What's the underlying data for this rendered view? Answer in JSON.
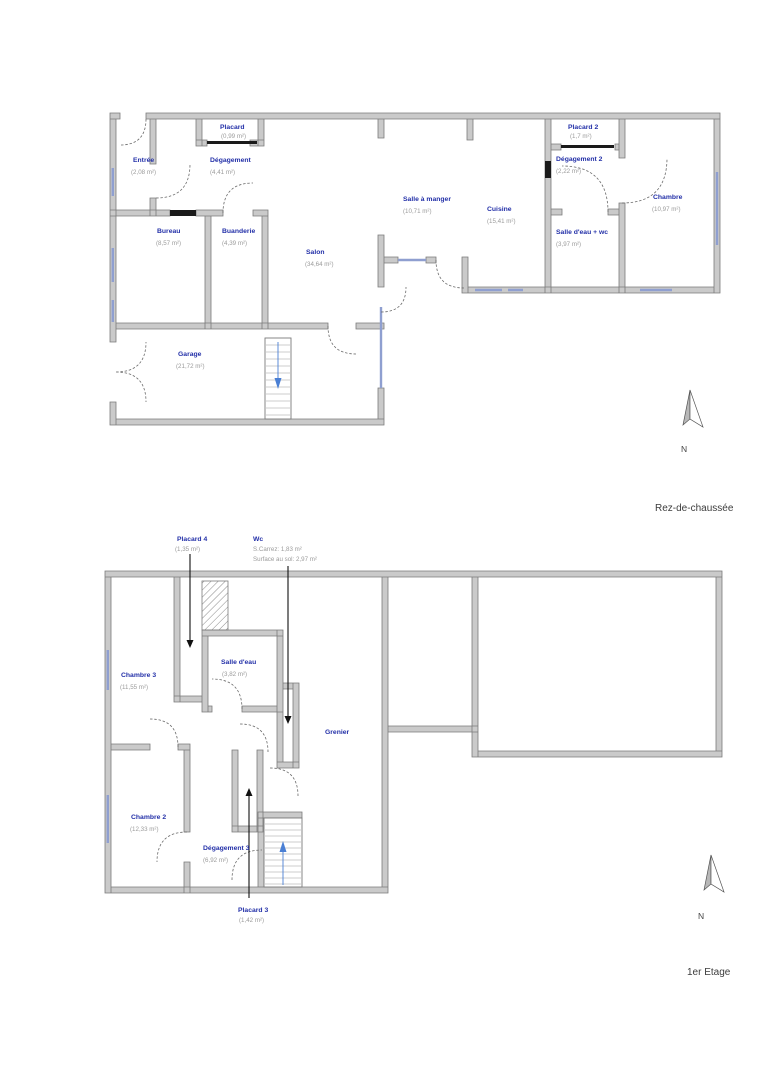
{
  "colors": {
    "room_name": "#2330a8",
    "area_text": "#9b9b9b",
    "wall_fill": "#cacaca",
    "window_line": "#8f9fd0",
    "stair_arrow": "#4a7fd4"
  },
  "ground_floor": {
    "title": "Rez-de-chaussée",
    "compass_label": "N",
    "rooms": [
      {
        "name": "Placard",
        "area": "(0,99 m²)"
      },
      {
        "name": "Entrée",
        "area": "(2,08 m²)"
      },
      {
        "name": "Dégagement",
        "area": "(4,41 m²)"
      },
      {
        "name": "Bureau",
        "area": "(8,57 m²)"
      },
      {
        "name": "Buanderie",
        "area": "(4,39 m²)"
      },
      {
        "name": "Salon",
        "area": "(34,64 m²)"
      },
      {
        "name": "Salle à manger",
        "area": "(10,71 m²)"
      },
      {
        "name": "Cuisine",
        "area": "(15,41 m²)"
      },
      {
        "name": "Placard 2",
        "area": "(1,7 m²)"
      },
      {
        "name": "Dégagement 2",
        "area": "(2,22 m²)"
      },
      {
        "name": "Chambre",
        "area": "(10,97 m²)"
      },
      {
        "name": "Salle d'eau + wc",
        "area": "(3,97 m²)"
      },
      {
        "name": "Garage",
        "area": "(21,72 m²)"
      }
    ]
  },
  "first_floor": {
    "title": "1er Etage",
    "compass_label": "N",
    "rooms": [
      {
        "name": "Placard 4",
        "area": "(1,35 m²)"
      },
      {
        "name": "Wc",
        "area_line1": "S.Carrez: 1,83 m²",
        "area_line2": "Surface au sol: 2,97 m²"
      },
      {
        "name": "Chambre 3",
        "area": "(11,55 m²)"
      },
      {
        "name": "Salle d'eau",
        "area": "(3,82 m²)"
      },
      {
        "name": "Grenier"
      },
      {
        "name": "Chambre 2",
        "area": "(12,33 m²)"
      },
      {
        "name": "Dégagement 3",
        "area": "(6,92 m²)"
      },
      {
        "name": "Placard 3",
        "area": "(1,42 m²)"
      }
    ]
  }
}
